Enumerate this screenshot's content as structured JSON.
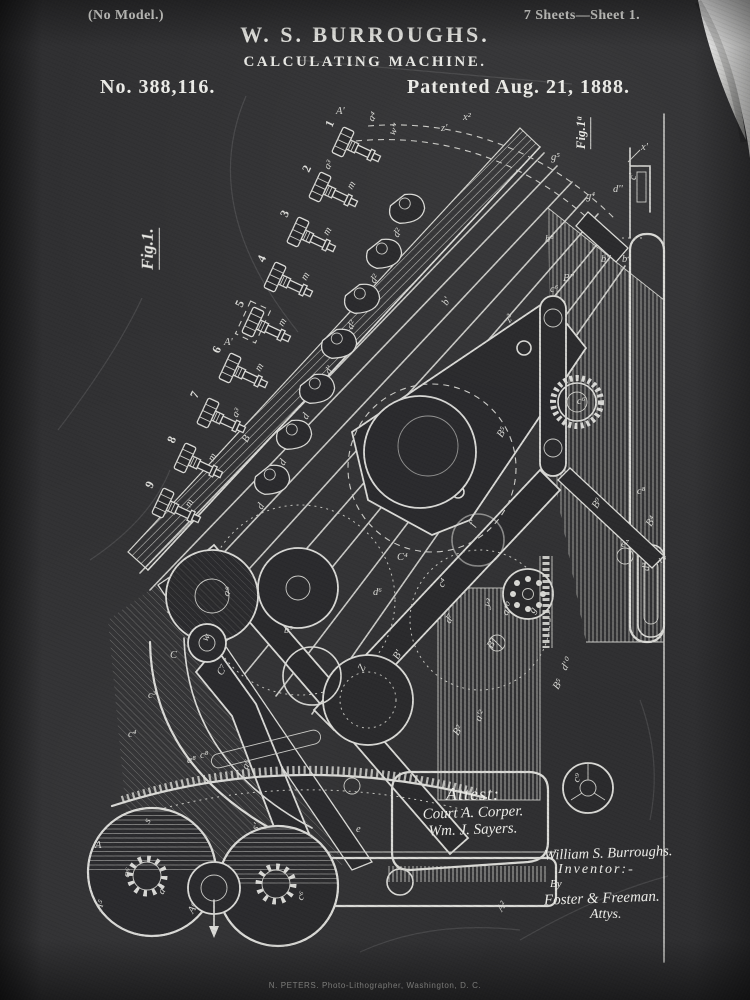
{
  "page": {
    "no_model": "(No Model.)",
    "sheets": "7 Sheets—Sheet 1.",
    "inventor_name": "W. S. BURROUGHS.",
    "invention_title": "CALCULATING MACHINE.",
    "patent_number": "No. 388,116.",
    "patent_date": "Patented Aug. 21, 1888.",
    "fig1_label": "Fig.1.",
    "fig1a_label": "Fig.1ᵃ",
    "printer_line": "N. PETERS. Photo-Lithographer, Washington, D. C."
  },
  "attest": {
    "heading": "Attest:",
    "witness1": "Court A. Corper.",
    "witness2": "Wm. J. Sayers."
  },
  "inventor_block": {
    "signature": "William S. Burroughs.",
    "role": "Inventor:-",
    "by": "By",
    "attorneys": "Foster & Freeman.",
    "attorneys_title": "Attys."
  },
  "colors": {
    "board": "#2f2f31",
    "chalk": "#e8e8e4",
    "curl_paper": "#f2f2f0"
  },
  "figure": {
    "key_numbers": [
      "1",
      "2",
      "3",
      "4",
      "5",
      "6",
      "7",
      "8",
      "9"
    ],
    "part_labels": [
      {
        "t": "A'",
        "x": 336,
        "y": 114,
        "r": 0
      },
      {
        "t": "a³",
        "x": 329,
        "y": 170,
        "r": -60
      },
      {
        "t": "m",
        "x": 352,
        "y": 190,
        "r": -60
      },
      {
        "t": "m",
        "x": 328,
        "y": 236,
        "r": -60
      },
      {
        "t": "m",
        "x": 306,
        "y": 281,
        "r": -60
      },
      {
        "t": "A'",
        "x": 224,
        "y": 345,
        "r": 0
      },
      {
        "t": "m",
        "x": 283,
        "y": 327,
        "r": -60
      },
      {
        "t": "m",
        "x": 260,
        "y": 372,
        "r": -60
      },
      {
        "t": "a³",
        "x": 237,
        "y": 418,
        "r": -60
      },
      {
        "t": "m",
        "x": 213,
        "y": 462,
        "r": -60
      },
      {
        "t": "m",
        "x": 190,
        "y": 508,
        "r": -60
      },
      {
        "t": "d²",
        "x": 398,
        "y": 238,
        "r": -60
      },
      {
        "t": "d²",
        "x": 375,
        "y": 284,
        "r": -60
      },
      {
        "t": "d²",
        "x": 352,
        "y": 330,
        "r": -60
      },
      {
        "t": "d'",
        "x": 330,
        "y": 375,
        "r": -60
      },
      {
        "t": "d",
        "x": 307,
        "y": 420,
        "r": -60
      },
      {
        "t": "d",
        "x": 284,
        "y": 466,
        "r": -60
      },
      {
        "t": "d",
        "x": 262,
        "y": 510,
        "r": -60
      },
      {
        "t": "x²",
        "x": 463,
        "y": 120,
        "r": 0
      },
      {
        "t": "z'",
        "x": 441,
        "y": 131,
        "r": 0
      },
      {
        "t": "a⁴",
        "x": 373,
        "y": 122,
        "r": -60
      },
      {
        "t": "w''",
        "x": 394,
        "y": 136,
        "r": -60
      },
      {
        "t": "g⁵",
        "x": 551,
        "y": 160,
        "r": 0
      },
      {
        "t": "g⁴",
        "x": 586,
        "y": 199,
        "r": 0
      },
      {
        "t": "b⁸",
        "x": 545,
        "y": 242,
        "r": 0
      },
      {
        "t": "b''",
        "x": 601,
        "y": 262,
        "r": 0
      },
      {
        "t": "B''",
        "x": 563,
        "y": 281,
        "r": 0
      },
      {
        "t": "x'",
        "x": 641,
        "y": 150,
        "r": 0
      },
      {
        "t": "c'",
        "x": 636,
        "y": 180,
        "r": -90
      },
      {
        "t": "d''",
        "x": 613,
        "y": 192,
        "r": 0
      },
      {
        "t": "b⁴",
        "x": 622,
        "y": 262,
        "r": 0
      },
      {
        "t": "b'",
        "x": 447,
        "y": 306,
        "r": -60
      },
      {
        "t": "c⁶",
        "x": 550,
        "y": 292,
        "r": 0
      },
      {
        "t": "z²",
        "x": 510,
        "y": 323,
        "r": -60
      },
      {
        "t": "c⁶",
        "x": 577,
        "y": 404,
        "r": 0
      },
      {
        "t": "B",
        "x": 247,
        "y": 443,
        "r": -60
      },
      {
        "t": "a⁹",
        "x": 228,
        "y": 597,
        "r": -60
      },
      {
        "t": "w",
        "x": 207,
        "y": 642,
        "r": -60
      },
      {
        "t": "B⁵",
        "x": 502,
        "y": 438,
        "r": -60
      },
      {
        "t": "C⁴",
        "x": 397,
        "y": 560,
        "r": 0
      },
      {
        "t": "d⁶",
        "x": 373,
        "y": 595,
        "r": 0
      },
      {
        "t": "b⁹",
        "x": 284,
        "y": 633,
        "r": 0
      },
      {
        "t": "Z",
        "x": 363,
        "y": 672,
        "r": -60
      },
      {
        "t": "C",
        "x": 170,
        "y": 658,
        "r": 0
      },
      {
        "t": "C⁷",
        "x": 222,
        "y": 676,
        "r": -60
      },
      {
        "t": "c³",
        "x": 148,
        "y": 698,
        "r": 0
      },
      {
        "t": "c⁴",
        "x": 128,
        "y": 737,
        "r": 0
      },
      {
        "t": "a⁶",
        "x": 247,
        "y": 770,
        "r": -60
      },
      {
        "t": "c⁸",
        "x": 200,
        "y": 758,
        "r": 0
      },
      {
        "t": "y³",
        "x": 489,
        "y": 608,
        "r": -60
      },
      {
        "t": "a'⁰",
        "x": 507,
        "y": 616,
        "r": -60
      },
      {
        "t": "g",
        "x": 534,
        "y": 614,
        "r": -60
      },
      {
        "t": "d⁷",
        "x": 450,
        "y": 624,
        "r": -60
      },
      {
        "t": "B⁷",
        "x": 492,
        "y": 649,
        "r": -60
      },
      {
        "t": "B'",
        "x": 398,
        "y": 660,
        "r": -60
      },
      {
        "t": "d'⁰",
        "x": 566,
        "y": 671,
        "r": -60
      },
      {
        "t": "B²",
        "x": 458,
        "y": 736,
        "r": -60
      },
      {
        "t": "a'²",
        "x": 480,
        "y": 722,
        "r": -60
      },
      {
        "t": "B⁵",
        "x": 558,
        "y": 690,
        "r": -60
      },
      {
        "t": "c⁹",
        "x": 578,
        "y": 783,
        "r": -60
      },
      {
        "t": "B⁹",
        "x": 597,
        "y": 509,
        "r": -60
      },
      {
        "t": "c⁸",
        "x": 637,
        "y": 494,
        "r": 0
      },
      {
        "t": "B⁴",
        "x": 651,
        "y": 527,
        "r": -60
      },
      {
        "t": "e⁷",
        "x": 621,
        "y": 547,
        "r": 0
      },
      {
        "t": "d³",
        "x": 649,
        "y": 571,
        "r": -90
      },
      {
        "t": "f'",
        "x": 474,
        "y": 527,
        "r": -60
      },
      {
        "t": "c⁴",
        "x": 443,
        "y": 588,
        "r": -60
      },
      {
        "t": "A",
        "x": 95,
        "y": 848,
        "r": 0
      },
      {
        "t": "A⁵",
        "x": 100,
        "y": 911,
        "r": -60
      },
      {
        "t": "a⁸",
        "x": 187,
        "y": 763,
        "r": 0
      },
      {
        "t": "s",
        "x": 149,
        "y": 824,
        "r": -60
      },
      {
        "t": "s'",
        "x": 257,
        "y": 831,
        "r": -60
      },
      {
        "t": "e",
        "x": 356,
        "y": 832,
        "r": 0
      },
      {
        "t": "c⁶",
        "x": 302,
        "y": 901,
        "r": -60
      },
      {
        "t": "A⁶",
        "x": 193,
        "y": 914,
        "r": -60
      },
      {
        "t": "a⁶",
        "x": 128,
        "y": 878,
        "r": -60
      },
      {
        "t": "a⁵",
        "x": 163,
        "y": 895,
        "r": -60
      },
      {
        "t": "A²",
        "x": 502,
        "y": 912,
        "r": -60
      },
      {
        "t": "x³",
        "x": 658,
        "y": 563,
        "r": 0
      }
    ]
  }
}
